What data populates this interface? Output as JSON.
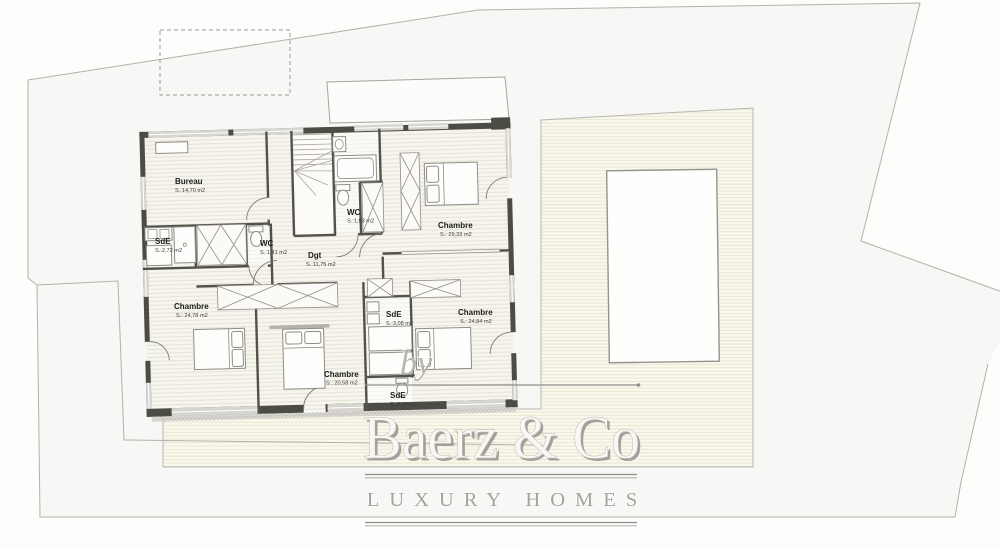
{
  "watermark": {
    "by": "by",
    "brand": "Baerz & Co",
    "tagline": "LUXURY HOMES"
  },
  "rooms": {
    "bureau": {
      "name": "Bureau",
      "area": "S.:14,70 m2"
    },
    "sde_left": {
      "name": "SdE",
      "area": "S.:2,72 m2"
    },
    "wc_small": {
      "name": "WC",
      "area": "S.:1,41 m2"
    },
    "wc_upper": {
      "name": "WC",
      "area": "S.:1,83 m2"
    },
    "dgt": {
      "name": "Dgt",
      "area": "S.:11,75 m2"
    },
    "chambre_top_right": {
      "name": "Chambre",
      "area": "S.:  29,33 m2"
    },
    "chambre_bottom_left": {
      "name": "Chambre",
      "area": "S.:  24,78 m2"
    },
    "chambre_bottom_middle": {
      "name": "Chambre",
      "area": "S.:  20,58 m2"
    },
    "chambre_bottom_right": {
      "name": "Chambre",
      "area": "S.:  24,84 m2"
    },
    "sde_middle": {
      "name": "SdE",
      "area": "S.:3,08 m2"
    },
    "sde_bottom": {
      "name": "SdE",
      "area": "S.:3,66 m2"
    }
  },
  "colors": {
    "wall": "#4c4b44",
    "floor": "#f6f5ee",
    "floor_line": "#e3e0d3",
    "deck": "#faf8ed",
    "deck_line": "#e8e4d1",
    "boundary": "#b3b1ab",
    "watermark_gray": "#9c9b97",
    "window_fill": "#d7d5cf"
  }
}
